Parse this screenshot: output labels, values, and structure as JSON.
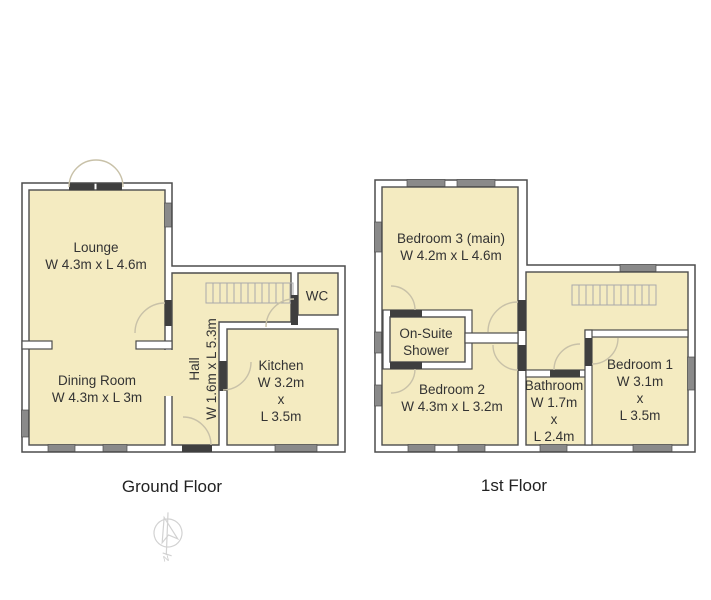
{
  "palette": {
    "room_fill": "#f4ebc1",
    "wall": "#4d4d4d",
    "window": "#8a8a8a",
    "door": "#3f3f3f",
    "arc": "#c8c1a8",
    "text": "#333333"
  },
  "floors": [
    {
      "label": "Ground Floor",
      "rooms": [
        {
          "name": "Lounge",
          "lines": [
            "Lounge",
            "W 4.3m x L 4.6m"
          ]
        },
        {
          "name": "Dining Room",
          "lines": [
            "Dining Room",
            "W 4.3m x L 3m"
          ]
        },
        {
          "name": "Hall",
          "lines": [
            "Hall",
            "W 1.6m x L 5.3m"
          ]
        },
        {
          "name": "Kitchen",
          "lines": [
            "Kitchen",
            "W 3.2m",
            "x",
            "L 3.5m"
          ]
        },
        {
          "name": "WC",
          "lines": [
            "WC"
          ]
        }
      ]
    },
    {
      "label": "1st Floor",
      "rooms": [
        {
          "name": "Bedroom 3 (main)",
          "lines": [
            "Bedroom 3 (main)",
            "W 4.2m x L 4.6m"
          ]
        },
        {
          "name": "On-Suite Shower",
          "lines": [
            "On-Suite",
            "Shower"
          ]
        },
        {
          "name": "Bedroom 2",
          "lines": [
            "Bedroom 2",
            "W 4.3m x L 3.2m"
          ]
        },
        {
          "name": "Bathroom",
          "lines": [
            "Bathroom",
            "W 1.7m",
            "x",
            "L 2.4m"
          ]
        },
        {
          "name": "Bedroom 1",
          "lines": [
            "Bedroom 1",
            "W 3.1m",
            "x",
            "L 3.5m"
          ]
        }
      ]
    }
  ],
  "compass": {
    "letter": "N"
  }
}
